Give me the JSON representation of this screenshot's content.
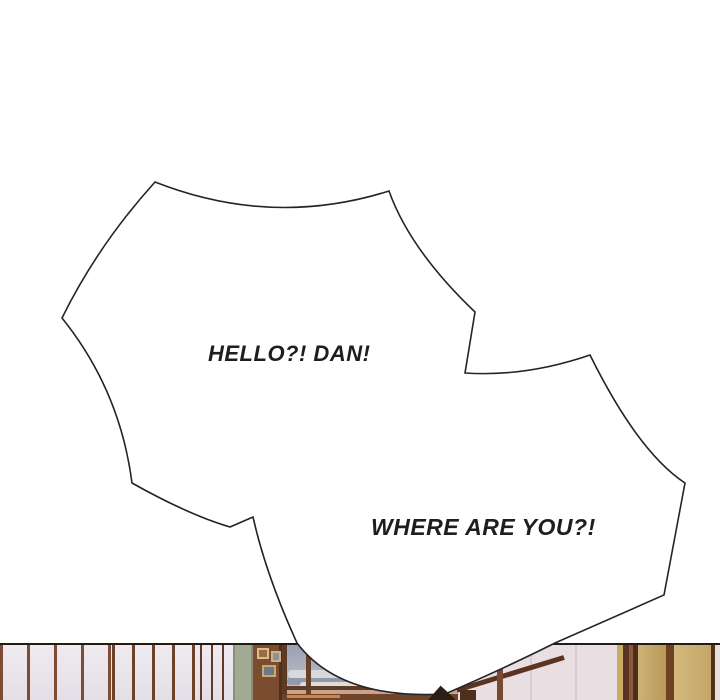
{
  "bubble": {
    "line1": "HELLO?! DAN!",
    "line2": "WHERE ARE YOU?!"
  },
  "colors": {
    "page_background": "#ffffff",
    "bubble_fill": "#ffffff",
    "bubble_outline": "#242424",
    "text_color": "#1e1e1e",
    "photo_border": "#241a12",
    "wall_panel": "#e9e4e9",
    "wall_stripe": "#7a4b33",
    "sage_column": "#a2aa93",
    "wood_column": "#7c4c30",
    "window_sky": "#99a1b2",
    "window_sill": "#6f4428",
    "right_panel": "#e9dee2",
    "tan_panel": "#c3a568",
    "hair_tip": "#2e1d14"
  }
}
